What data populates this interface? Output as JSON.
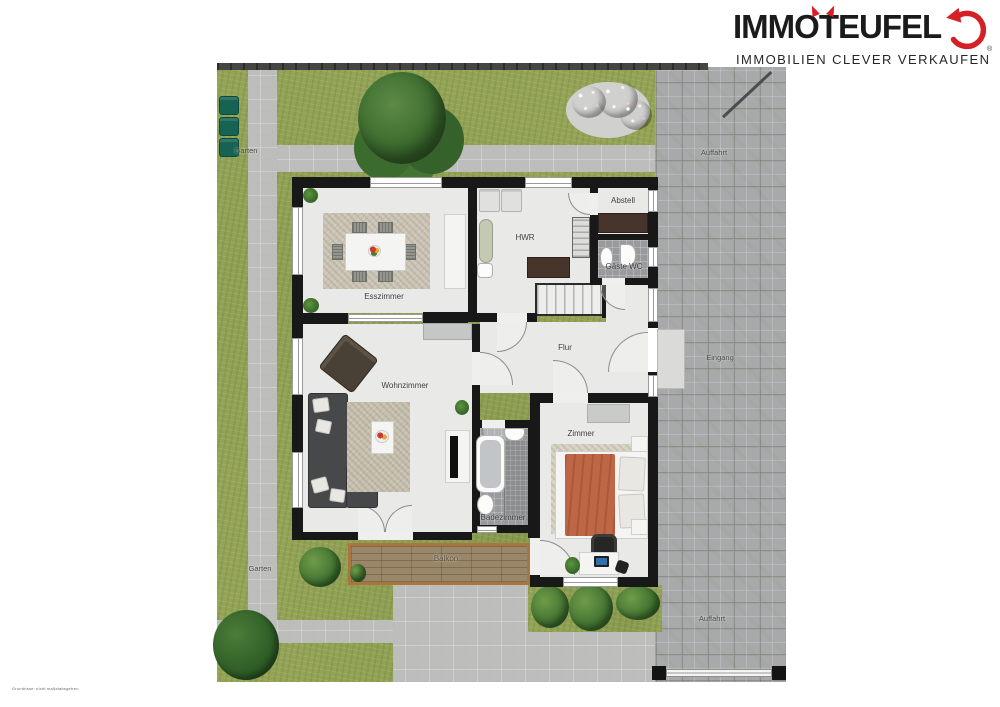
{
  "logo": {
    "title": "IMMOTEUFEL",
    "tagline": "IMMOBILIEN CLEVER VERKAUFEN",
    "registered": "®",
    "accent_color": "#d42127",
    "text_color": "#1b1b1b"
  },
  "plan": {
    "rooms": {
      "esszimmer": "Esszimmer",
      "hwr": "HWR",
      "abstell": "Abstell",
      "gaeste_wc": "Gäste WC",
      "flur": "Flur",
      "wohnzimmer": "Wohnzimmer",
      "zimmer": "Zimmer",
      "badezimmer": "Badezimmer",
      "balkon": "Balkon"
    },
    "outdoor": {
      "garten": "Garten",
      "auffahrt": "Auffahrt",
      "eingang": "Eingang"
    },
    "colors": {
      "grass": "#94a457",
      "paving": "#bdbebc",
      "driveway": "#a7a9ab",
      "wall": "#181818",
      "deck": "#9a8668",
      "bed_blanket": "#bd6746"
    }
  },
  "footer": {
    "disclaimer": "Grundrisse: nicht maßstabsgetreu"
  }
}
